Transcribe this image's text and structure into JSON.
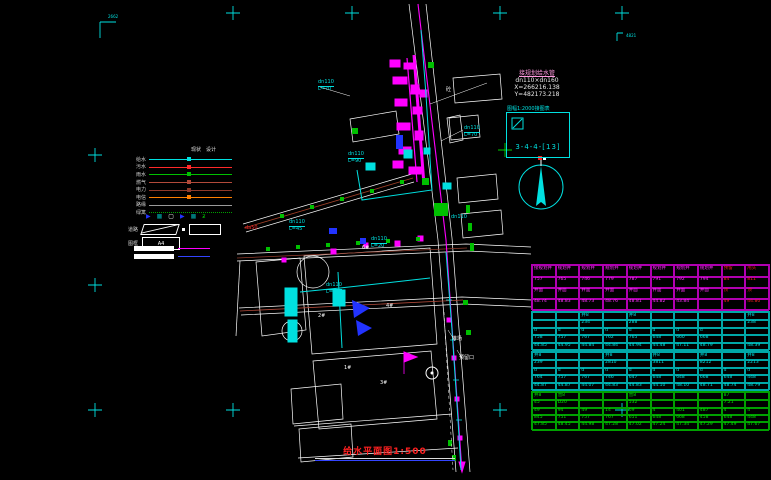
{
  "drawing": {
    "title": "给水平面图1:500"
  },
  "sheet": {
    "corner_label": "2662",
    "right_edge_label": "4821"
  },
  "annotation_block": {
    "lines": [
      "接规划给水管",
      "dn110×dn160",
      "X=266216.138",
      "Y=482173.218"
    ]
  },
  "grid_ref_box": {
    "title": "图幅1:2000接图表",
    "code": "3-4-4-[13]"
  },
  "icons": {
    "arrow": "▶",
    "valve": "■",
    "box": "▢",
    "plant": "ƶ"
  },
  "legend": {
    "headers": [
      "现状",
      "设计"
    ],
    "rows": [
      {
        "label": "给水",
        "color": "#00e0e0",
        "dotted": false,
        "marker": true
      },
      {
        "label": "污水",
        "color": "#ff2a2a",
        "dotted": false,
        "marker": true
      },
      {
        "label": "雨水",
        "color": "#00c000",
        "dotted": false,
        "marker": true
      },
      {
        "label": "燃气",
        "color": "#b24a3a",
        "dotted": false,
        "marker": true
      },
      {
        "label": "电力",
        "color": "#8f3a2a",
        "dotted": false,
        "marker": true
      },
      {
        "label": "电信",
        "color": "#ff8000",
        "dotted": false,
        "marker": true
      },
      {
        "label": "路缘",
        "color": "#9a9a9a",
        "dotted": false,
        "marker": false
      },
      {
        "label": "绿篱",
        "color": "#00a000",
        "dotted": true,
        "marker": false
      }
    ],
    "road_label": "道路",
    "frame_label": "图框",
    "frame_value": "A4"
  },
  "map": {
    "labels": [
      {
        "text": "dn110\nL=70",
        "x": 318,
        "y": 80,
        "c": "#00e0e0"
      },
      {
        "text": "dn110\nL=70",
        "x": 464,
        "y": 126,
        "c": "#00e0e0"
      },
      {
        "text": "dn110\nL=90",
        "x": 348,
        "y": 152,
        "c": "#00e0e0"
      },
      {
        "text": "dn110\nL=45",
        "x": 289,
        "y": 220,
        "c": "#00e0e0"
      },
      {
        "text": "dn110\nL=20",
        "x": 371,
        "y": 237,
        "c": "#00e0e0"
      },
      {
        "text": "dn110\nL=45",
        "x": 326,
        "y": 283,
        "c": "#00e0e0"
      },
      {
        "text": "da50",
        "x": 245,
        "y": 226,
        "c": "#ff2a2a"
      },
      {
        "text": "dn110",
        "x": 451,
        "y": 215,
        "c": "#00e0e0"
      },
      {
        "text": "砼",
        "x": 446,
        "y": 88,
        "c": "#ffffff"
      },
      {
        "text": "6#",
        "x": 362,
        "y": 246,
        "c": "#ffffff"
      },
      {
        "text": "4#",
        "x": 386,
        "y": 304,
        "c": "#ffffff"
      },
      {
        "text": "2#",
        "x": 318,
        "y": 314,
        "c": "#ffffff"
      },
      {
        "text": "1#",
        "x": 344,
        "y": 366,
        "c": "#ffffff"
      },
      {
        "text": "3#",
        "x": 380,
        "y": 381,
        "c": "#ffffff"
      },
      {
        "text": "堆场",
        "x": 452,
        "y": 337,
        "c": "#ffffff"
      },
      {
        "text": "预留口",
        "x": 459,
        "y": 356,
        "c": "#ffffff"
      }
    ]
  },
  "table": {
    "groups": [
      {
        "border": "#b000b0",
        "color": "#ff30ff",
        "alt_color": "#ff2020",
        "alt_cols": [
          8,
          9
        ],
        "row_h": 11,
        "rows": [
          [
            "接规划井",
            "规划井",
            "规划井",
            "规划井",
            "规划井",
            "规划井",
            "规划井",
            "规划井",
            "预留",
            "甩头"
          ],
          [
            "757",
            "765",
            "746",
            "779",
            "787",
            "791",
            "792",
            "794",
            "84",
            "811"
          ],
          [
            "井面",
            "井面",
            "井面",
            "井面",
            "井面",
            "井面",
            "井面",
            "井面",
            "顶",
            "顶"
          ],
          [
            "48.74",
            "48.83",
            "48.73",
            "48.76",
            "48.81",
            "44.82",
            "43.84",
            "",
            "49",
            "44.80"
          ]
        ]
      },
      {
        "border": "#00a8a8",
        "color": "#00e0e0",
        "row_h": 7.4,
        "rows": [
          [
            "",
            "",
            "井8",
            "",
            "井8",
            "",
            "",
            "",
            "",
            "井8"
          ],
          [
            "",
            "",
            "234",
            "",
            "288",
            "",
            "",
            "",
            "",
            "238"
          ],
          [
            "d",
            "d",
            "d",
            "d",
            "d",
            "d",
            "d",
            "d",
            "",
            ""
          ],
          [
            "758",
            "757",
            "767",
            "762",
            "765",
            "648",
            "660",
            "668",
            "",
            ""
          ],
          [
            "44.85",
            "44.95",
            "44.84",
            "44.84",
            "44.94",
            "44.48",
            "47.11",
            "48.79",
            "",
            "48.39"
          ]
        ]
      },
      {
        "border": "#00a8a8",
        "color": "#00e0e0",
        "row_h": 7.4,
        "rows": [
          [
            "井8",
            "",
            "",
            "井8",
            "",
            "井8",
            "",
            "井8",
            "",
            "井8"
          ],
          [
            "239",
            "",
            "",
            "2810",
            "",
            "3811",
            "",
            "8212",
            "",
            "2213"
          ],
          [
            "d",
            "d",
            "d",
            "d",
            "d",
            "d",
            "d",
            "d",
            "d",
            "d"
          ],
          [
            "764",
            "757",
            "767",
            "746",
            "647",
            "648",
            "648",
            "668",
            "648",
            "448"
          ],
          [
            "44.87",
            "44.87",
            "44.07",
            "44.83",
            "44.83",
            "44.10",
            "48.10",
            "48.71",
            "48.74",
            "48.79"
          ]
        ]
      },
      {
        "border": "#00a000",
        "color": "#00e000",
        "row_h": 7.4,
        "rows": [
          [
            "井8",
            "营8",
            "",
            "",
            "营8",
            "",
            "",
            "",
            "87",
            ""
          ],
          [
            "45",
            "D20",
            "",
            "",
            "532",
            "",
            "",
            "",
            "7.21",
            ""
          ],
          [
            "49",
            "94",
            "49",
            "14",
            "69",
            "4",
            "401",
            "487",
            "4",
            "4"
          ],
          [
            "845",
            "751",
            "757",
            "767",
            "651",
            "648",
            "668",
            "458",
            "648",
            "448"
          ],
          [
            "47.85",
            "48.45",
            "44.98",
            "47.28",
            "47.02",
            "47.24",
            "47.34",
            "47.29",
            "47.49",
            "47.67"
          ]
        ]
      }
    ]
  }
}
